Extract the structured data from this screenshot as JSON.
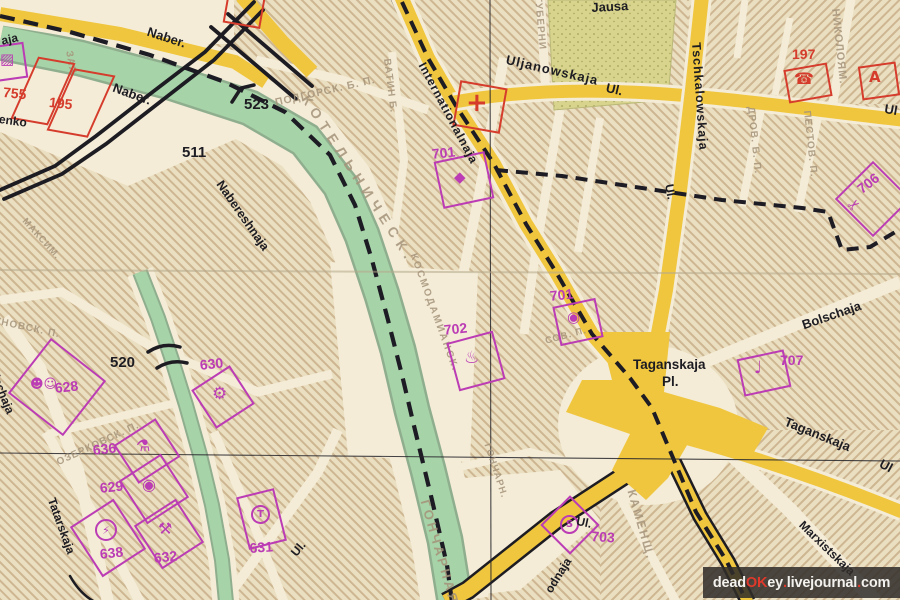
{
  "map": {
    "street_labels": {
      "aja": "aja",
      "naber_top": "Naber.",
      "naber_mid": "Naber.",
      "enko": "enko",
      "nabereshnaja": "Nabereshnaja",
      "internationalnaja": "Internationalnaja",
      "uljanowskaja": "Uljanowskaja",
      "uljanowskaja_ul": "Ul.",
      "ul_right_edge": "Ul",
      "jausa": "Jausa",
      "tschkalowskaja": "Tschkalowskaja",
      "tschkalowskaja_ul": "Ul.",
      "bolschaja_right": "Bolschaja",
      "taganskaja_pl_line1": "Taganskaja",
      "taganskaja_pl_line2": "Pl.",
      "taganskaja_se": "Taganskaja",
      "taganskaja_se_ul": "Ul",
      "marxistskaja": "Marxistskaja",
      "ul_near_703": "Ul.",
      "odnaja": "odnaja",
      "ul_bottom_left": "Ul.",
      "bolschaja_left": "Bolschaja",
      "tatarskaja": "Tatarskaja"
    },
    "bridge_numbers": {
      "n511": "511",
      "n520": "520",
      "n523": "523"
    },
    "red_markers": {
      "n755": "755",
      "n195": "195",
      "n197": "197"
    },
    "magenta_markers": {
      "n701a": "701",
      "n701b": "701",
      "n702": "702",
      "n703": "703",
      "n706": "706",
      "n707": "707",
      "n628": "628",
      "n629": "629",
      "n630": "630",
      "n631": "631",
      "n632": "632",
      "n636": "636",
      "n638": "638"
    },
    "icons": {
      "hospital": "+",
      "telephone": "☎",
      "fire_station": "A",
      "cinema": "◆",
      "camera": "◉",
      "tavern": "♨",
      "boot": "♩",
      "services": "✂",
      "masks": "☻☺",
      "gear": "⚙",
      "flask": "⚗",
      "lens": "◉",
      "lightning": "⚡",
      "workshop": "⚒",
      "letter_s": "S",
      "letter_t": "T",
      "partial": "▨"
    },
    "faint_labels": {
      "kotelnitscheskaja": "КОТЕЛЬНИЧЕСК.",
      "kosmodamianskaja": "КОСМОДАМИАНСК.",
      "gontscharnaja": "ГОНЧАРНАЯ",
      "gontscharn": "ГОНЧАРН.",
      "podgorsk": "ПОДГОРСК. Б. П.",
      "watin": "ВАТИН Б.",
      "guberni": "ГУБЕРНИ",
      "nikolojam": "НИКОЛОЯМ.",
      "pestow": "ПЕСТОВ. П.",
      "drow": "ДРОВ. Б. П.",
      "kamenschtsch": "КАМЕНЩ.",
      "oserkowsk": "ОЗЕРКОВСК. П.",
      "runowsk": "РУНОВСК. П.",
      "sow_p": "СОВ. П.",
      "saja": "ЗАЯ.",
      "maxim": "МАКСИМ."
    }
  },
  "watermark": {
    "p1": "dead",
    "p2": "OK",
    "p3": "ey",
    "p4": ".",
    "p5": "livejournal",
    "p6": ".",
    "p7": "com"
  },
  "colors": {
    "paper": "#f0e7cf",
    "river": "#a7d3a8",
    "park": "#d8d48d",
    "road": "#f0c63e",
    "red": "#d53c2c",
    "magenta": "#bb3cb4",
    "ink": "#1d1c22"
  }
}
